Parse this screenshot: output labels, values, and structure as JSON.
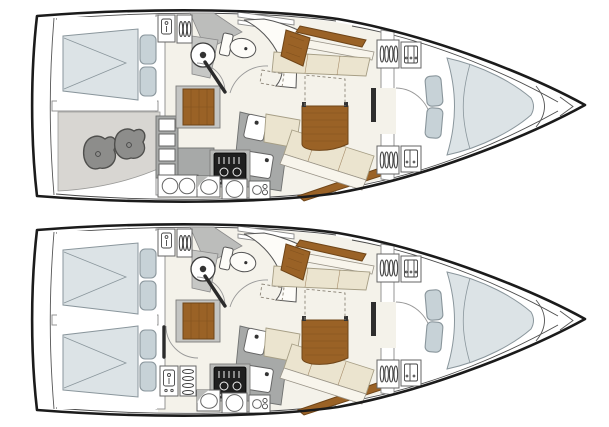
{
  "image": {
    "kind": "sailboat-interior-layout-plan",
    "views": 2,
    "orientation": "bow-right",
    "background": "#ffffff"
  },
  "palette": {
    "ink": "#1b1b1b",
    "white": "#ffffff",
    "floor": "#f4f2ea",
    "counter": "#a7a9a8",
    "wood": "#9a6226",
    "woodDark": "#6f4518",
    "cushion": "#ebe4cf",
    "cushionEdge": "#a69e85",
    "backrest": "#f8f5ec",
    "mattress": "#dce3e6",
    "pillow": "#c7d2d7",
    "berthEdge": "#8a969c",
    "storageFloor": "#d8d6d2",
    "gear": "#8d8d8b",
    "gearEdge": "#4f4f4d",
    "stove": "#1f1f1f"
  },
  "layouts": [
    {
      "position": "top",
      "aft_areas": [
        "double-berth-cabin",
        "storage-room-with-gear"
      ],
      "midship": [
        "companionway-steps",
        "head-with-toilet-and-basin",
        "l-shaped-galley-with-stove-and-sinks",
        "saloon-with-table-and-settees"
      ],
      "forward": [
        "hanging-lockers",
        "v-berth-cabin",
        "anchor-locker"
      ]
    },
    {
      "position": "bottom",
      "aft_areas": [
        "double-berth-cabin",
        "double-berth-cabin"
      ],
      "midship": [
        "companionway-steps",
        "head-with-toilet-and-basin",
        "galley-with-stove-and-sinks",
        "saloon-with-table-and-settees"
      ],
      "forward": [
        "hanging-lockers",
        "v-berth-cabin",
        "anchor-locker"
      ]
    }
  ]
}
